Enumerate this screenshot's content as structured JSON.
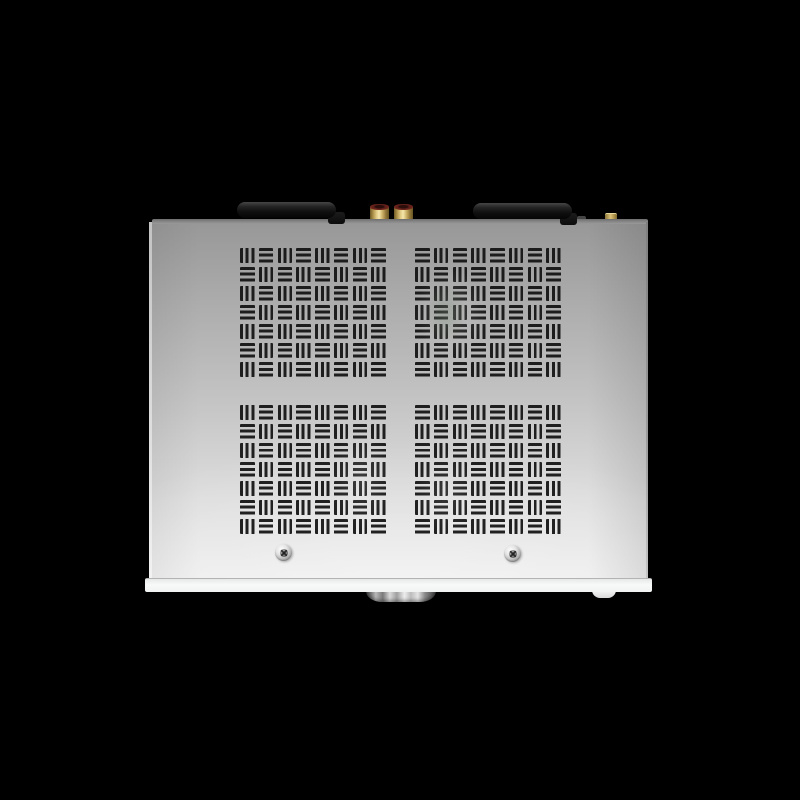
{
  "meta": {
    "domain": "Natural-Image",
    "description": "Studio product photograph on a black background: top view of a silver hi-fi amplifier / audio streamer chassis"
  },
  "device": {
    "name": "silver-amplifier-top-view",
    "chassis": {
      "finish": "brushed aluminum silver",
      "surface_gradient": [
        "#989898",
        "#c4c4c4",
        "#eeeeee"
      ],
      "back_edge_color": "#8d8d8d",
      "front_strip_color": "#f5f6f6"
    },
    "background_color": "#000000",
    "vents": {
      "pattern": "basket-weave grille of 3-bar slot groups",
      "rows": 7,
      "cols": 8,
      "slot_color": "#121212",
      "quadrants": [
        {
          "id": "top-left",
          "first": "vertical"
        },
        {
          "id": "top-right",
          "first": "horizontal"
        },
        {
          "id": "bottom-left",
          "first": "vertical"
        },
        {
          "id": "bottom-right",
          "first": "horizontal"
        }
      ]
    },
    "components": {
      "antennas": [
        {
          "id": "left",
          "color": "#111111",
          "position": "rear-left, folded flat, hinge on right end"
        },
        {
          "id": "right",
          "color": "#111111",
          "position": "rear-right, folded flat, hinge on right end"
        }
      ],
      "rca_jacks": [
        {
          "id": "left",
          "body_color": "#cdb267",
          "cap_color": "#5a1d17"
        },
        {
          "id": "right",
          "body_color": "#cdb267",
          "cap_color": "#5a1d17"
        }
      ],
      "sma_antenna_connector": {
        "color": "#d9c07a"
      },
      "screws": [
        {
          "id": "front-left",
          "type": "phillips",
          "color": "#c6c6c6"
        },
        {
          "id": "front-right",
          "type": "phillips",
          "color": "#c6c6c6"
        }
      ],
      "volume_knob": {
        "finish": "polished metal with vertical reflections",
        "color": "#bcbcbc"
      },
      "small_front_knob": {
        "color": "#ededed"
      }
    }
  }
}
